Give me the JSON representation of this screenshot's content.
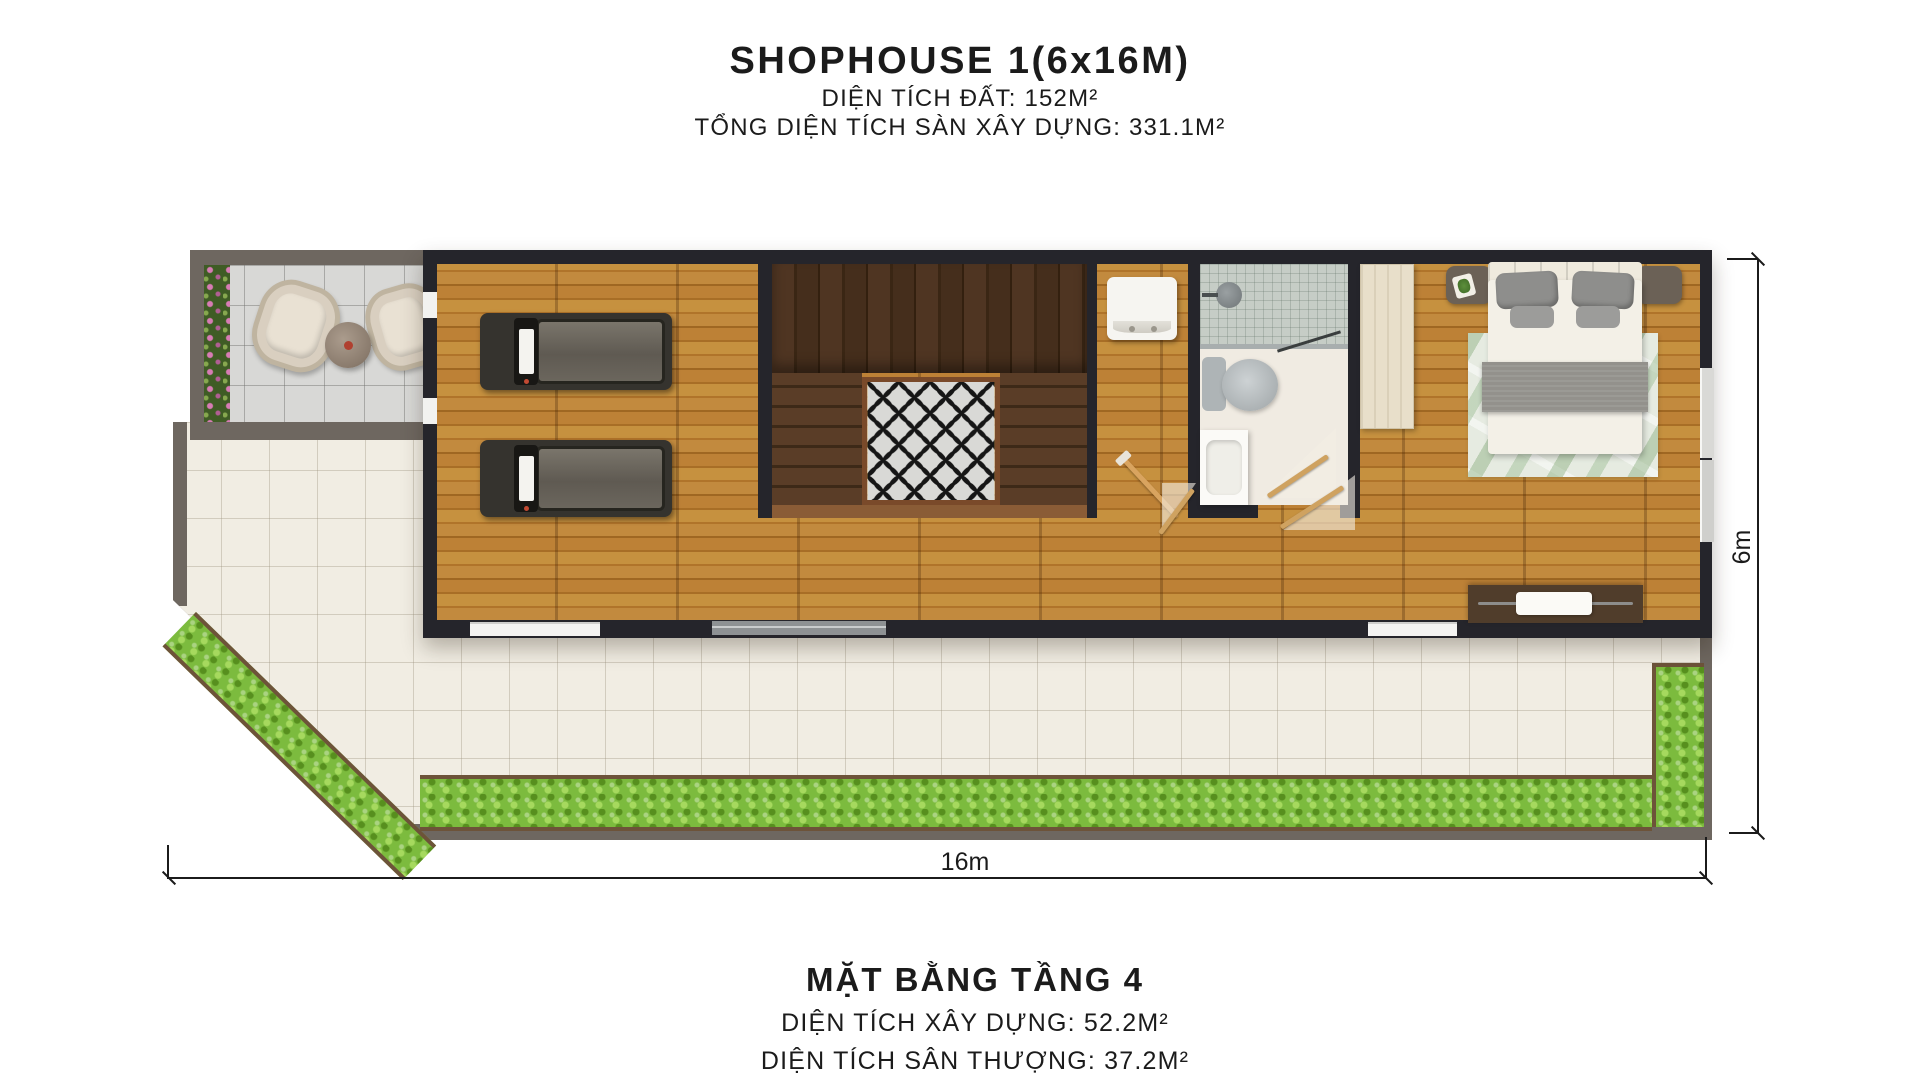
{
  "header": {
    "title": "SHOPHOUSE 1(6x16M)",
    "land_area": "DIỆN TÍCH ĐẤT: 152M²",
    "total_floor_area": "TỔNG DIỆN TÍCH SÀN XÂY DỰNG: 331.1M²"
  },
  "footer": {
    "title": "MẶT BẰNG TẦNG 4",
    "built_area": "DIỆN TÍCH XÂY DỰNG: 52.2M²",
    "terrace_area": "DIỆN TÍCH SÂN THƯỢNG: 37.2M²"
  },
  "dimensions": {
    "width_label": "16m",
    "height_label": "6m"
  },
  "colors": {
    "wood": "#b97c31",
    "stair-wood": "#46301d",
    "wall": "#25252b",
    "terrace-wall": "#6e6760",
    "terrace-tile": "#f1ede3",
    "balcony-tile": "#d8d8d6",
    "hedge": "#7cbb3e",
    "planter": "#6d5339",
    "flower": "#d77cb4",
    "rug": "#e6ebe1",
    "ink": "#1b1b1b"
  }
}
